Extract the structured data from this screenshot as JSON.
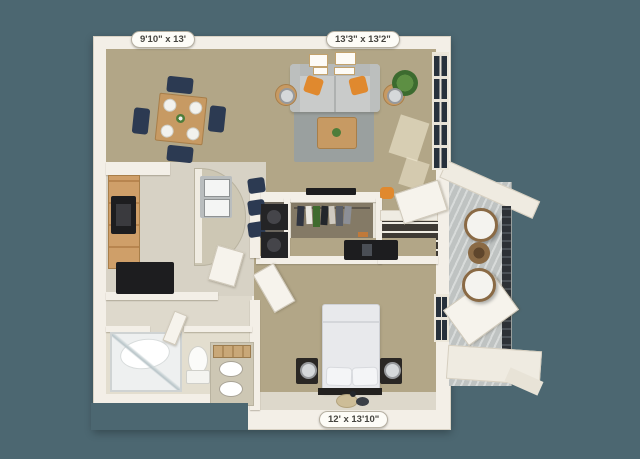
{
  "canvas": {
    "width": 640,
    "height": 459,
    "background_color": "#4c6771"
  },
  "floor_plan": {
    "type": "3d-apartment-floor-plan",
    "dimension_labels": {
      "dining": "9'10\" x 13'",
      "living": "13'3\" x 13'2\"",
      "bedroom": "12' x 13'10\""
    },
    "colors": {
      "bg": "#4c6771",
      "wall": "#f3efe7",
      "wall-shadow": "#d5cec0",
      "carpet": "#b2a687",
      "hard-floor": "#d7d2c5",
      "bath-floor": "#e3decf",
      "closet-floor": "#847a66",
      "balcony-floor": "#c3c6c5",
      "railing": "#2d3136",
      "sofa": "#c9cbca",
      "accent-pillow": "#e0892e",
      "rug": "#9aa09f",
      "wood": "#c79a63",
      "wood-cabinet": "#cf9f69",
      "navy-seat": "#2c3a52",
      "appliance-black": "#1d1d1f",
      "granite": "#cdc7b4",
      "plant-green": "#4e7d3a",
      "window-pane": "#27313c",
      "wicker": "#8a6a45"
    },
    "furniture_icons": [
      "dining-table",
      "dining-chair",
      "plate",
      "sofa",
      "accent-pillow",
      "coffee-table",
      "side-table",
      "table-lamp",
      "area-rug",
      "wall-art-frame",
      "potted-plant",
      "kitchen-cabinets",
      "wall-oven",
      "refrigerator",
      "kitchen-island",
      "double-sink",
      "bar-stool",
      "washer-dryer",
      "hanging-clothes",
      "shoe-shelf",
      "tv",
      "bed",
      "bed-pillow",
      "nightstand",
      "bedside-lamp",
      "desk",
      "bench",
      "pouf-rug",
      "bathtub-shower",
      "toilet",
      "vanity-sink",
      "towels",
      "open-door",
      "balcony-chair",
      "balcony-wicker-table",
      "balcony-railing",
      "window"
    ]
  }
}
